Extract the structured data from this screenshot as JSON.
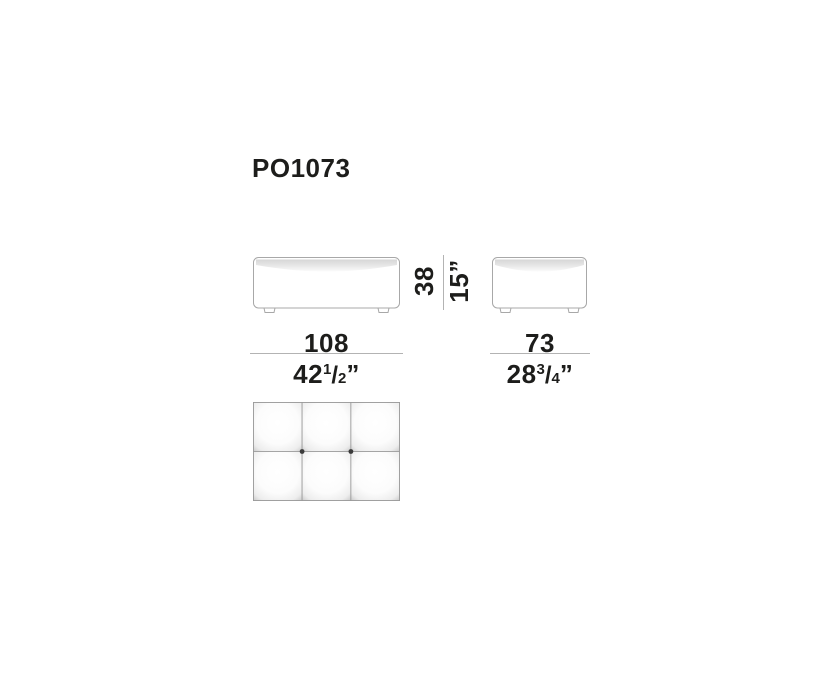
{
  "page": {
    "background": "#ffffff",
    "type": "furniture-dimension-drawing"
  },
  "product": {
    "code": "PO1073"
  },
  "colors": {
    "text": "#1d1d1b",
    "outline": "#a8a8a8",
    "dimension_line": "#b3b3b3",
    "cushion_shade": "#d8d8d8",
    "cushion_edge": "#c6c6c6",
    "button": "#3a3a3a"
  },
  "views": {
    "front": {
      "label": "front-view"
    },
    "side": {
      "label": "side-view"
    },
    "top": {
      "label": "top-view",
      "grid_cols": 3,
      "grid_rows": 2,
      "button_count": 2
    }
  },
  "dimensions": {
    "width": {
      "cm": "108",
      "in_whole": "42",
      "in_num": "1",
      "in_den": "2",
      "in_mark": "”"
    },
    "depth": {
      "cm": "73",
      "in_whole": "28",
      "in_num": "3",
      "in_den": "4",
      "in_mark": "”"
    },
    "height": {
      "cm": "38",
      "in": "15”"
    }
  }
}
